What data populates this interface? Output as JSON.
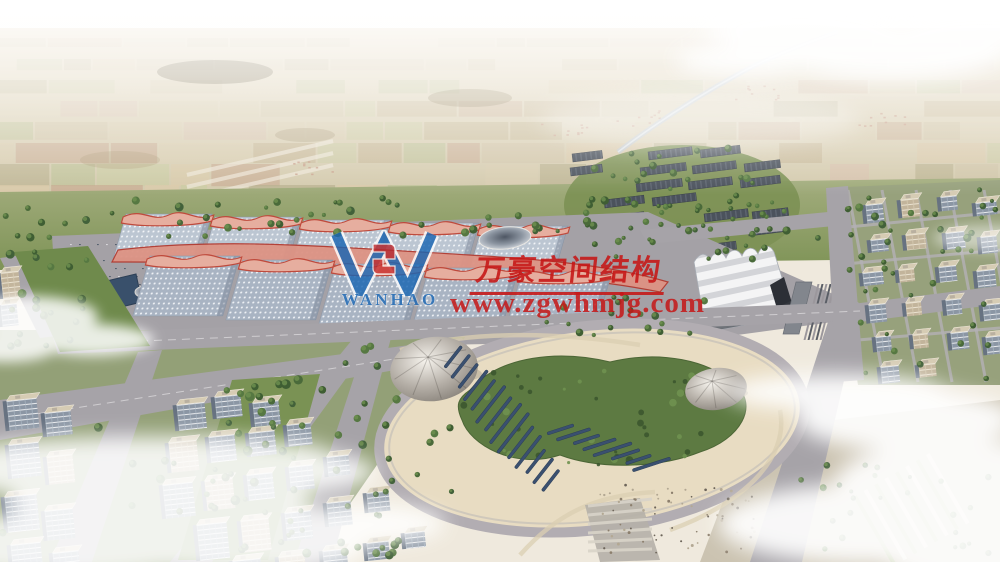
{
  "image": {
    "kind": "aerial architectural rendering",
    "subject": "large exhibition-center campus with pink wave-canopy halls, white pleated hall, central landscaped oval park, residential blocks and hazy farmland horizon",
    "dimensions": "1000x562"
  },
  "watermark": {
    "logo_text": "WANHAO",
    "company_name_cn": "万豪空间结构",
    "website": "www.zgwhmjg.com",
    "text_color": "#c61616",
    "logo_color": "#1a66b3",
    "logo_mark_color": "#c62222"
  },
  "palette": {
    "sky_haze": "#f6f1e7",
    "farmland": "#d9cdb0",
    "hall_roof": "#b9c3cf",
    "canopy_pink": "#e6ae9f",
    "canopy_ridge": "#bf4a3c",
    "asphalt": "#a6a3a8",
    "park_sand": "#e8dcc2",
    "tree_green": "#4a6a3a",
    "panel_blue": "#3a5070"
  }
}
